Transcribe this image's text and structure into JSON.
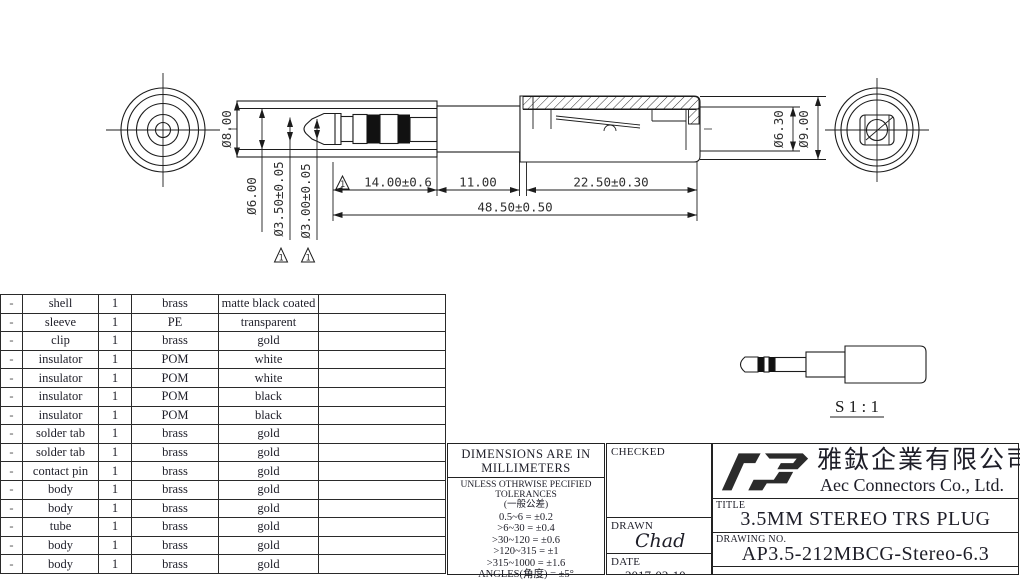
{
  "drawing": {
    "dims": {
      "dia_8": "Ø8.00",
      "dia_6": "Ø6.00",
      "dia_3_5": "Ø3.50±0.05",
      "dia_3_0": "Ø3.00±0.05",
      "len_14": "14.00±0.6",
      "len_11": "11.00",
      "len_22_5": "22.50±0.30",
      "len_48_5": "48.50±0.50",
      "dia_6_3": "Ø6.30",
      "dia_9": "Ø9.00",
      "flag_note": "1"
    },
    "scale_label": "S 1 : 1"
  },
  "parts_table": {
    "rows": [
      {
        "item": "-",
        "name": "shell",
        "qty": "1",
        "material": "brass",
        "finish": "matte black coated",
        "note": ""
      },
      {
        "item": "-",
        "name": "sleeve",
        "qty": "1",
        "material": "PE",
        "finish": "transparent",
        "note": ""
      },
      {
        "item": "-",
        "name": "clip",
        "qty": "1",
        "material": "brass",
        "finish": "gold",
        "note": ""
      },
      {
        "item": "-",
        "name": "insulator",
        "qty": "1",
        "material": "POM",
        "finish": "white",
        "note": ""
      },
      {
        "item": "-",
        "name": "insulator",
        "qty": "1",
        "material": "POM",
        "finish": "white",
        "note": ""
      },
      {
        "item": "-",
        "name": "insulator",
        "qty": "1",
        "material": "POM",
        "finish": "black",
        "note": ""
      },
      {
        "item": "-",
        "name": "insulator",
        "qty": "1",
        "material": "POM",
        "finish": "black",
        "note": ""
      },
      {
        "item": "-",
        "name": "solder tab",
        "qty": "1",
        "material": "brass",
        "finish": "gold",
        "note": ""
      },
      {
        "item": "-",
        "name": "solder tab",
        "qty": "1",
        "material": "brass",
        "finish": "gold",
        "note": ""
      },
      {
        "item": "-",
        "name": "contact pin",
        "qty": "1",
        "material": "brass",
        "finish": "gold",
        "note": ""
      },
      {
        "item": "-",
        "name": "body",
        "qty": "1",
        "material": "brass",
        "finish": "gold",
        "note": ""
      },
      {
        "item": "-",
        "name": "body",
        "qty": "1",
        "material": "brass",
        "finish": "gold",
        "note": ""
      },
      {
        "item": "-",
        "name": "tube",
        "qty": "1",
        "material": "brass",
        "finish": "gold",
        "note": ""
      },
      {
        "item": "-",
        "name": "body",
        "qty": "1",
        "material": "brass",
        "finish": "gold",
        "note": ""
      },
      {
        "item": "-",
        "name": "body",
        "qty": "1",
        "material": "brass",
        "finish": "gold",
        "note": ""
      }
    ]
  },
  "tolerance_block": {
    "heading_line1": "DIMENSIONS ARE IN",
    "heading_line2": "MILLIMETERS",
    "sub_line1": "UNLESS OTHRWISE PECIFIED",
    "sub_line2": "TOLERANCES",
    "sub_line3": "(一般公差)",
    "lines": [
      "0.5~6 = ±0.2",
      ">6~30 = ±0.4",
      ">30~120 = ±0.6",
      ">120~315 = ±1",
      ">315~1000 = ±1.6",
      "ANGLES(角度) = ±5°"
    ]
  },
  "title_block": {
    "checked_label": "CHECKED",
    "drawn_label": "DRAWN",
    "drawn_value": "Chad",
    "date_label": "DATE",
    "date_value": "2017-02-10",
    "company_cn": "雅鈦企業有限公司",
    "company_en": "Aec Connectors Co., Ltd.",
    "title_label": "TITLE",
    "title_value": "3.5MM STEREO TRS PLUG",
    "drawing_no_label": "DRAWING NO.",
    "drawing_no_value": "AP3.5-212MBCG-Stereo-6.3"
  }
}
